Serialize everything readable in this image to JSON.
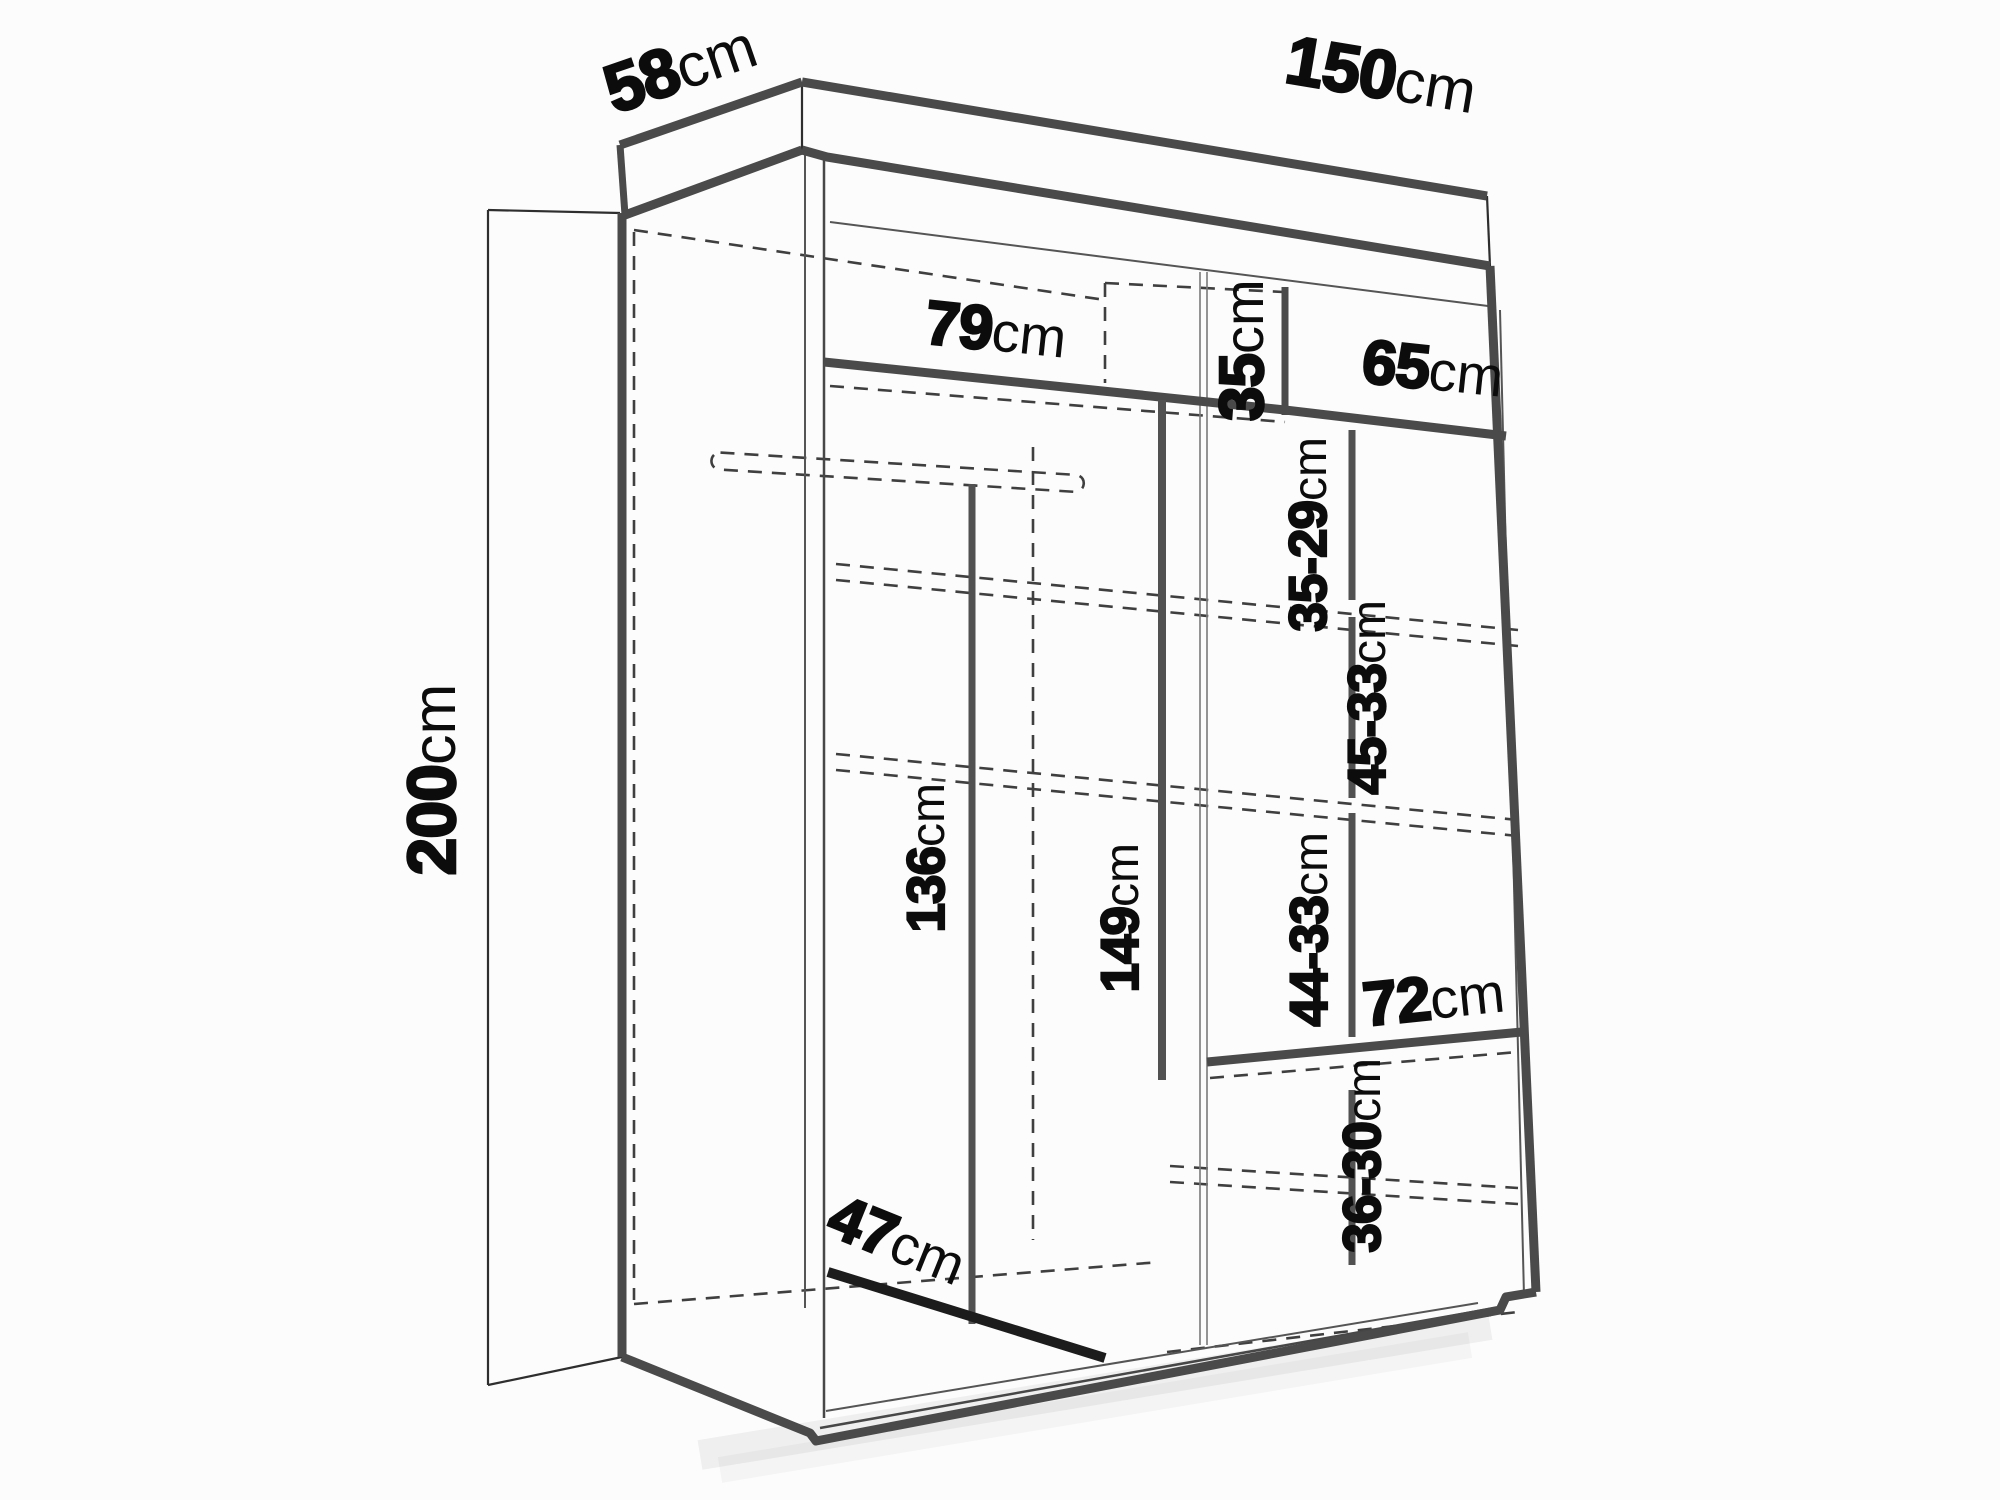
{
  "diagram": {
    "type": "furniture-dimension-drawing",
    "subject": "wardrobe interior dimensions, perspective line drawing",
    "unit": "cm",
    "dimensions": {
      "depth_top": {
        "value": "58",
        "unit": "cm",
        "meaning": "overall depth (top edge)"
      },
      "width_top": {
        "value": "150",
        "unit": "cm",
        "meaning": "overall width (top edge)"
      },
      "height_left": {
        "value": "200",
        "unit": "cm",
        "meaning": "overall height (left side)"
      },
      "shelf_left": {
        "value": "79",
        "unit": "cm",
        "meaning": "left top shelf width"
      },
      "cubby_height": {
        "value": "35",
        "unit": "cm",
        "meaning": "top-right cubby height"
      },
      "shelf_right": {
        "value": "65",
        "unit": "cm",
        "meaning": "right top shelf width"
      },
      "gap_1": {
        "value": "35-29",
        "unit": "cm",
        "meaning": "right column compartment 1 height"
      },
      "gap_2": {
        "value": "45-33",
        "unit": "cm",
        "meaning": "right column compartment 2 height"
      },
      "gap_3": {
        "value": "44-33",
        "unit": "cm",
        "meaning": "right column compartment 3 height"
      },
      "shelf_72": {
        "value": "72",
        "unit": "cm",
        "meaning": "lower right shelf width"
      },
      "gap_4": {
        "value": "36-30",
        "unit": "cm",
        "meaning": "right column bottom compartment height"
      },
      "rod_height": {
        "value": "136",
        "unit": "cm",
        "meaning": "hanging space height"
      },
      "divider_height": {
        "value": "149",
        "unit": "cm",
        "meaning": "middle divider height"
      },
      "depth_bottom": {
        "value": "47",
        "unit": "cm",
        "meaning": "interior usable depth at floor"
      }
    }
  },
  "colors": {
    "bg": "#fcfcfc",
    "line": "#4a4a4a",
    "thin": "#555555",
    "faint": "#7a7a7a",
    "dash": "#3f3f3f",
    "dim": "#515151",
    "label": "#0c0c0c",
    "black": "#1c1c1c"
  }
}
